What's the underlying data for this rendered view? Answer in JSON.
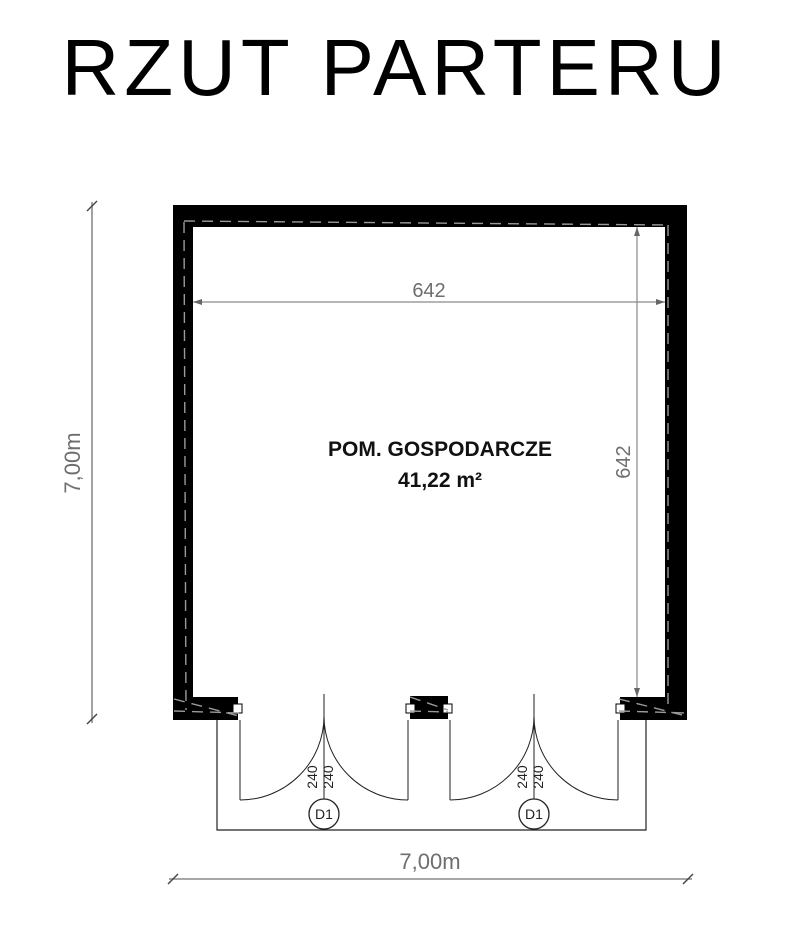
{
  "title": "RZUT PARTERU",
  "plan": {
    "room": {
      "name": "POM. GOSPODARCZE",
      "area": "41,22 m²"
    },
    "dimensions": {
      "inner_width": "642",
      "inner_height": "642",
      "outer_height": "7,00m",
      "outer_width": "7,00m"
    },
    "doors": [
      {
        "tag": "D1",
        "width": "240",
        "height": "240"
      },
      {
        "tag": "D1",
        "width": "240",
        "height": "240"
      }
    ]
  },
  "colors": {
    "wall": "#000000",
    "dimension_line": "#8a8a8a",
    "dashed_overlay": "#9a9a9a",
    "drawing_line": "#222222"
  }
}
